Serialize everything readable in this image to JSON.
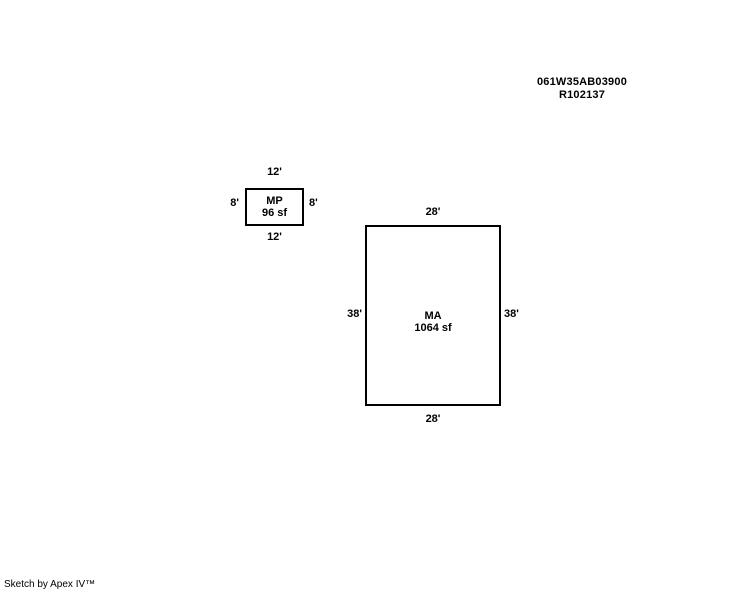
{
  "colors": {
    "background": "#ffffff",
    "line": "#000000",
    "text": "#000000"
  },
  "header": {
    "parcel_id": "061W35AB03900",
    "account_id": "R102137"
  },
  "sketch": {
    "buildings": [
      {
        "code": "MP",
        "area": "96 sf",
        "dim_top": "12'",
        "dim_bottom": "12'",
        "dim_left": "8'",
        "dim_right": "8'"
      },
      {
        "code": "MA",
        "area": "1064 sf",
        "dim_top": "28'",
        "dim_bottom": "28'",
        "dim_left": "38'",
        "dim_right": "38'"
      }
    ]
  },
  "footer": {
    "credit": "Sketch by Apex IV™"
  }
}
